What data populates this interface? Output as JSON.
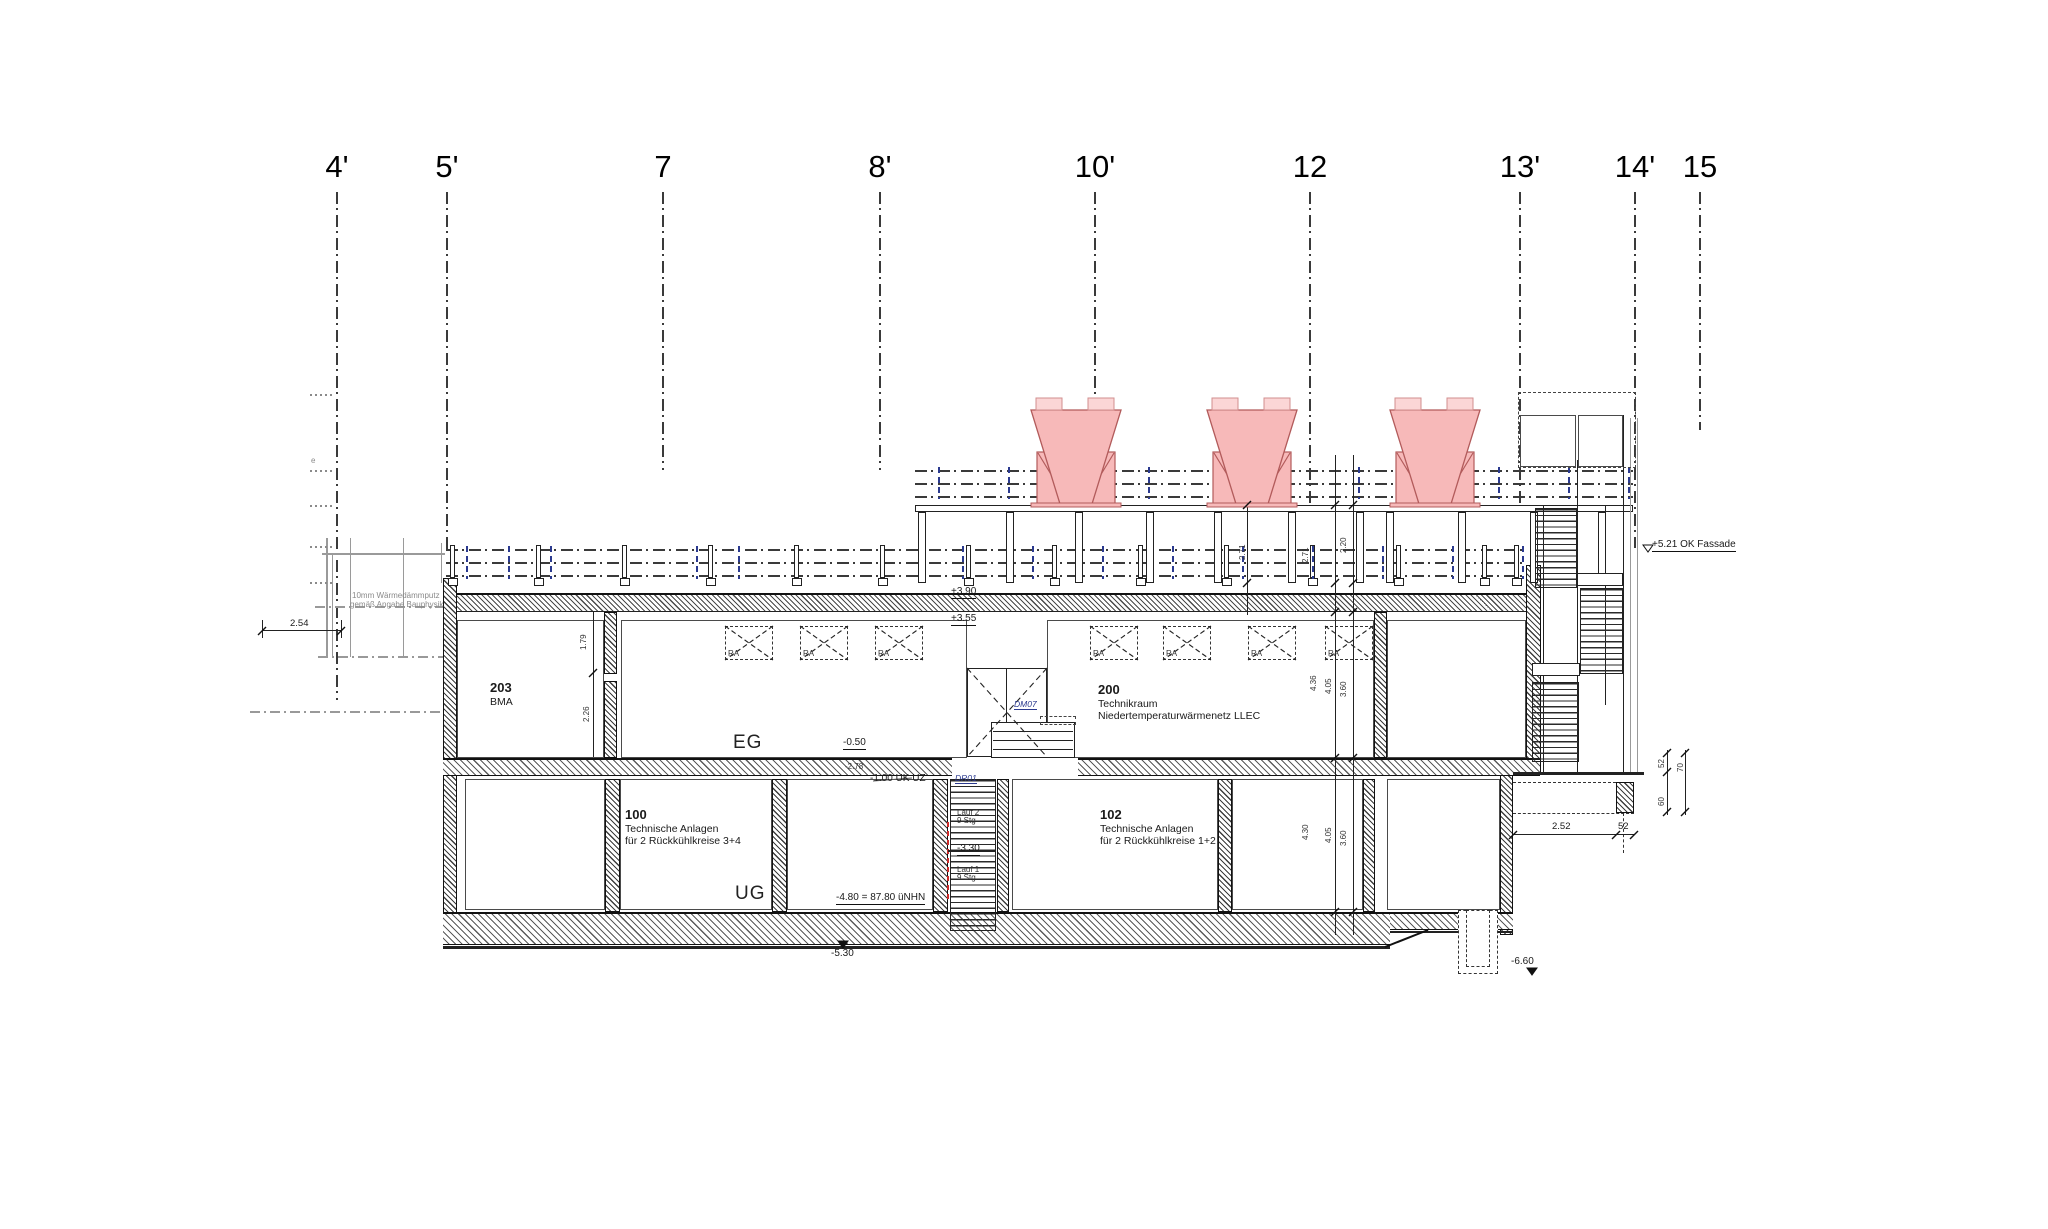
{
  "drawing": {
    "grid_axes": [
      {
        "label": "4'",
        "x": 337,
        "line_bottom": 700
      },
      {
        "label": "5'",
        "x": 447,
        "line_bottom": 552
      },
      {
        "label": "7",
        "x": 663,
        "line_bottom": 470
      },
      {
        "label": "8'",
        "x": 880,
        "line_bottom": 470
      },
      {
        "label": "10'",
        "x": 1095,
        "line_bottom": 505
      },
      {
        "label": "12",
        "x": 1310,
        "line_bottom": 505
      },
      {
        "label": "13'",
        "x": 1520,
        "line_bottom": 505
      },
      {
        "label": "14'",
        "x": 1635,
        "line_bottom": 548
      },
      {
        "label": "15",
        "x": 1700,
        "line_bottom": 430
      }
    ],
    "rooms": [
      {
        "number": "203",
        "lines": [
          "BMA"
        ],
        "x": 490,
        "y": 681
      },
      {
        "number": "200",
        "lines": [
          "Technikraum",
          "Niedertemperaturwärmenetz LLEC"
        ],
        "x": 1098,
        "y": 683
      },
      {
        "number": "100",
        "lines": [
          "Technische Anlagen",
          "für 2 Rückkühlkreise 3+4"
        ],
        "x": 625,
        "y": 808
      },
      {
        "number": "102",
        "lines": [
          "Technische Anlagen",
          "für 2 Rückkühlkreise 1+2"
        ],
        "x": 1100,
        "y": 808
      }
    ],
    "floor_labels": [
      {
        "text": "EG",
        "x": 733,
        "y": 733
      },
      {
        "text": "UG",
        "x": 735,
        "y": 884
      }
    ],
    "levels": [
      {
        "text": "+3.90",
        "x": 951,
        "y": 586,
        "style": "ul"
      },
      {
        "text": "+3.55",
        "x": 951,
        "y": 613,
        "style": "ul"
      },
      {
        "text": "-0.50",
        "x": 843,
        "y": 737,
        "style": "ul"
      },
      {
        "text": "-2.78",
        "x": 845,
        "y": 763,
        "style": "tiny"
      },
      {
        "text": "-1.00 UK UZ",
        "x": 870,
        "y": 773,
        "style": "plain"
      },
      {
        "text": "-4.80 = 87.80 üNHN",
        "x": 836,
        "y": 892,
        "style": "ul"
      },
      {
        "text": "-5.30",
        "x": 831,
        "y": 948,
        "style": "tri"
      },
      {
        "text": "-6.60",
        "x": 1511,
        "y": 956,
        "style": "tri"
      },
      {
        "text": "+5.21 OK Fassade",
        "x": 1652,
        "y": 539,
        "style": "ul"
      },
      {
        "text": "-3.30",
        "x": 957,
        "y": 843,
        "style": "ul"
      }
    ],
    "stair_labels": [
      {
        "text": "DM07",
        "x": 1014,
        "y": 700,
        "style": "blue"
      },
      {
        "text": "DR01",
        "x": 955,
        "y": 774,
        "style": "blue"
      },
      {
        "text": "Lauf 2",
        "x": 957,
        "y": 809,
        "style": "tiny"
      },
      {
        "text": "9 Stg",
        "x": 957,
        "y": 817,
        "style": "tiny"
      },
      {
        "text": "Lauf 1",
        "x": 957,
        "y": 866,
        "style": "tiny"
      },
      {
        "text": "9 Stg",
        "x": 957,
        "y": 874,
        "style": "tiny"
      }
    ],
    "notes": [
      {
        "text": "10mm Wärmedämmputz",
        "x": 352,
        "y": 592
      },
      {
        "text": "gemäß Angabe Bauphysik",
        "x": 350,
        "y": 601
      },
      {
        "text": "e",
        "x": 311,
        "y": 457
      }
    ],
    "dims_h": [
      {
        "text": "2.54",
        "x": 290,
        "y": 619
      },
      {
        "text": "2.52",
        "x": 1552,
        "y": 822
      },
      {
        "text": "52",
        "x": 1618,
        "y": 822
      }
    ],
    "dims_rot": [
      {
        "text": "1.79",
        "x": 580,
        "y": 650
      },
      {
        "text": "2.26",
        "x": 583,
        "y": 722
      },
      {
        "text": "2.71",
        "x": 1239,
        "y": 560
      },
      {
        "text": "2.71",
        "x": 1302,
        "y": 563
      },
      {
        "text": "2.20",
        "x": 1340,
        "y": 553
      },
      {
        "text": "4.36",
        "x": 1310,
        "y": 691
      },
      {
        "text": "4.05",
        "x": 1325,
        "y": 694
      },
      {
        "text": "3.60",
        "x": 1340,
        "y": 697
      },
      {
        "text": "4.30",
        "x": 1302,
        "y": 840
      },
      {
        "text": "4.05",
        "x": 1325,
        "y": 843
      },
      {
        "text": "3.60",
        "x": 1340,
        "y": 846
      },
      {
        "text": "52",
        "x": 1658,
        "y": 768
      },
      {
        "text": "70",
        "x": 1677,
        "y": 772
      },
      {
        "text": "60",
        "x": 1658,
        "y": 806
      }
    ],
    "ducts": {
      "label": "RA",
      "y": 626,
      "w": 48,
      "h": 34,
      "xs": [
        725,
        800,
        875,
        1090,
        1163,
        1248,
        1325
      ]
    },
    "towers": {
      "centers": [
        1076,
        1252,
        1435
      ],
      "top_y": 410,
      "base_y": 505
    }
  },
  "colors": {
    "tower_fill": "#f7b9b9",
    "tower_stroke": "#b25b5b",
    "tower_stub_fill": "#fbd6d6",
    "tower_stub_stroke": "#d18f8f",
    "accent_blue": "#2b3a8f",
    "accent_red": "#cc2a2a",
    "line": "#222222",
    "gray": "#9a9a9a"
  }
}
